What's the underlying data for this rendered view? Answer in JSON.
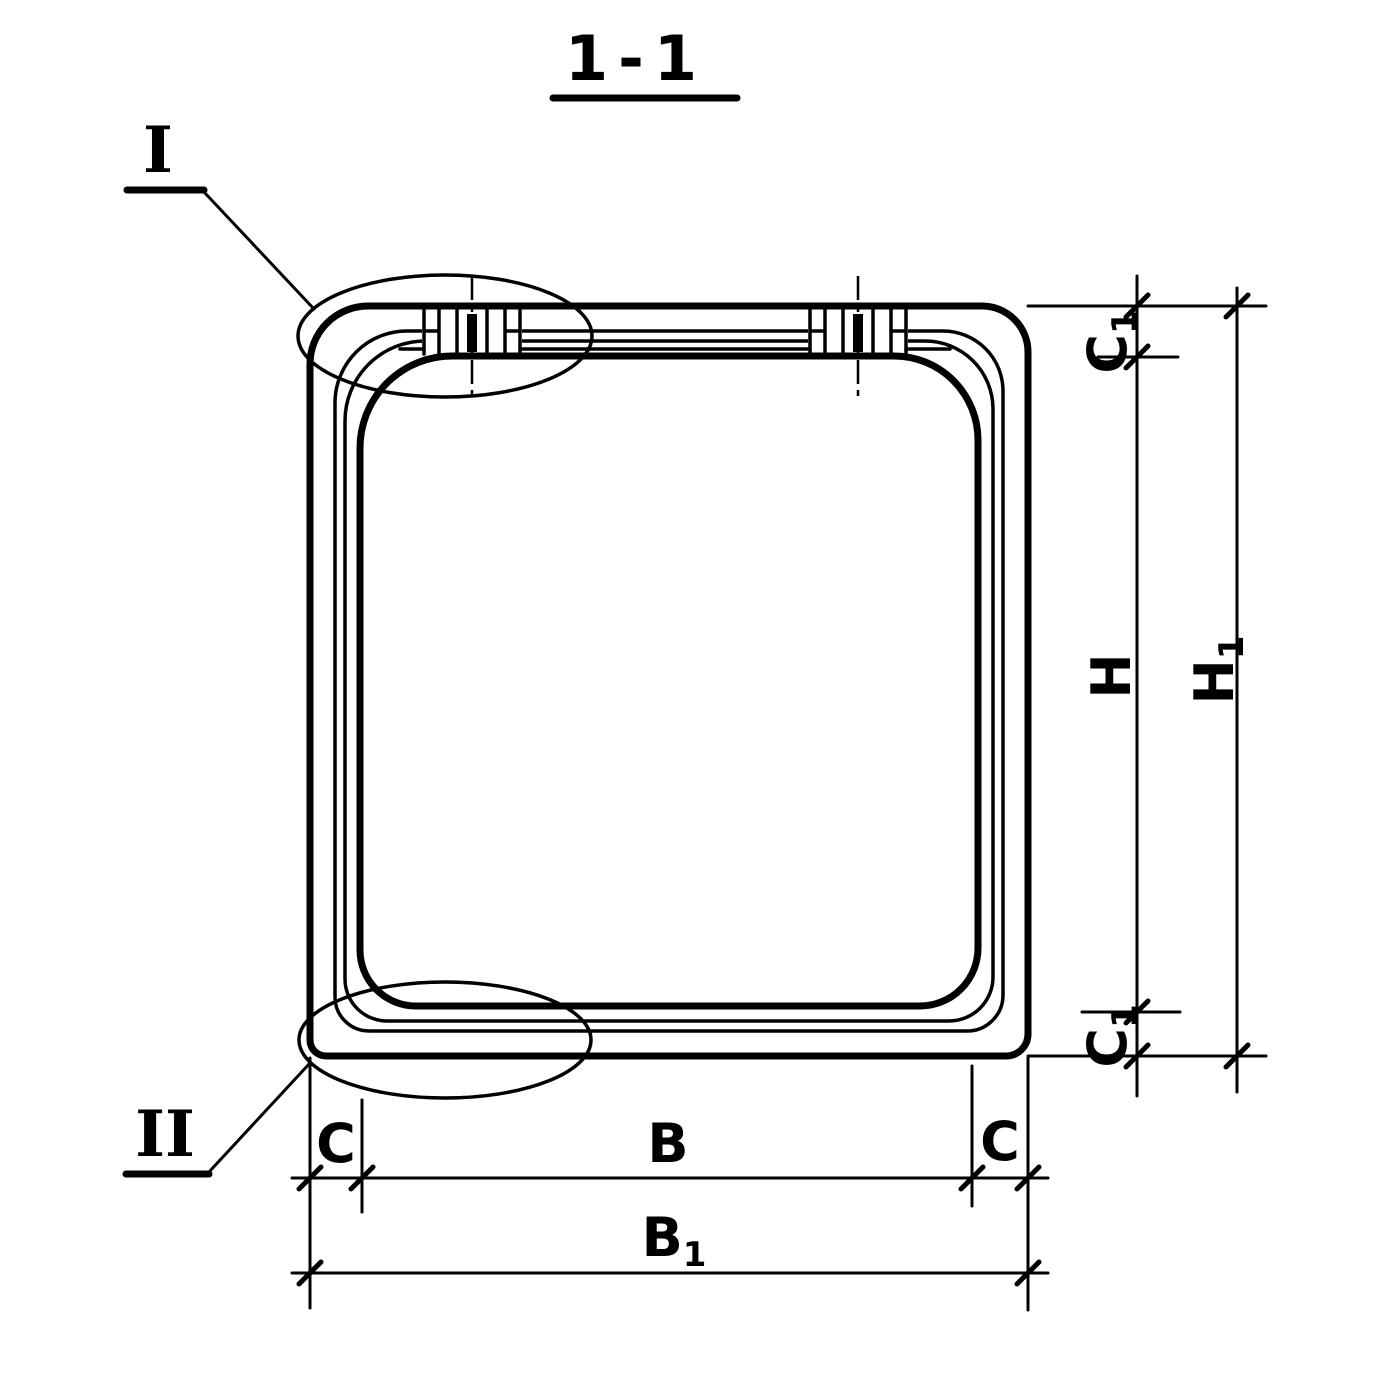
{
  "page": {
    "background": "#ffffff",
    "ink": "#000000"
  },
  "title": {
    "text": "1-1"
  },
  "detail_markers": {
    "detail_I": {
      "label": "I"
    },
    "detail_II": {
      "label": "II"
    }
  },
  "dimensions": {
    "c1_top": {
      "main": "C",
      "sub": "1"
    },
    "h": {
      "main": "H"
    },
    "h1": {
      "main": "H",
      "sub": "1"
    },
    "c1_bottom": {
      "main": "C",
      "sub": "1"
    },
    "c_left": {
      "main": "C"
    },
    "b": {
      "main": "B"
    },
    "c_right": {
      "main": "C"
    },
    "b1": {
      "main": "B",
      "sub": "1"
    }
  }
}
